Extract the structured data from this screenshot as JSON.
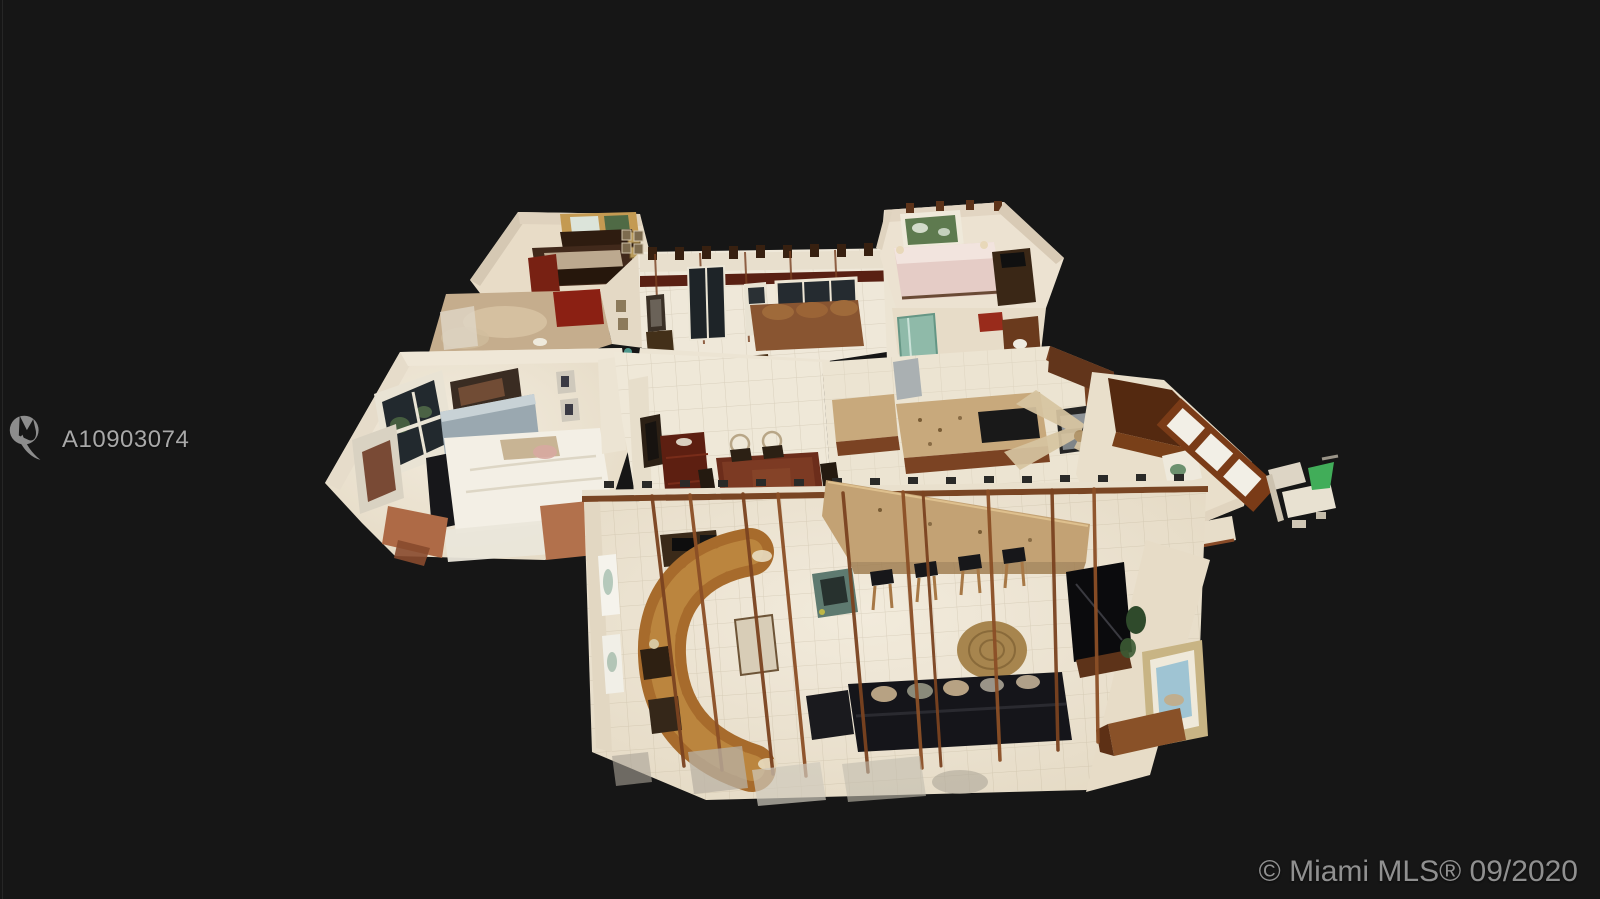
{
  "meta": {
    "type": "real-estate-listing-photo",
    "description": "Overhead 3D dollhouse (Matterport-style) scan of a single-story home interior floating on a dark background, with MLS listing watermark and copyright stamp."
  },
  "watermark": {
    "icon": "miami-mls-logo-icon",
    "listing_id": "A10903074"
  },
  "copyright": {
    "text": "© Miami MLS® 09/2020"
  },
  "palette": {
    "bg": "#161616",
    "edge-line": "#2a2a2a",
    "watermark-gray": "#a8a8a8",
    "copyright-gray": "#909090",
    "wall-cream": "#e9dfcd",
    "floor-tile": "#ece3d2",
    "wood-dark": "#5e3318",
    "wood-mid": "#7a4424",
    "mahogany": "#6e2d1a",
    "granite": "#c9a97b",
    "leather": "#a96b2a",
    "teal-glass": "#7fb5a4",
    "pink-bedding": "#e6ccc6",
    "white-bed": "#f2eee4"
  },
  "scene": {
    "rooms": [
      "bedroom-1",
      "bathroom-1",
      "master-bedroom",
      "foyer-living",
      "bedroom-2",
      "bathroom-2",
      "kitchen",
      "den-office",
      "dining-area",
      "family-room"
    ]
  }
}
